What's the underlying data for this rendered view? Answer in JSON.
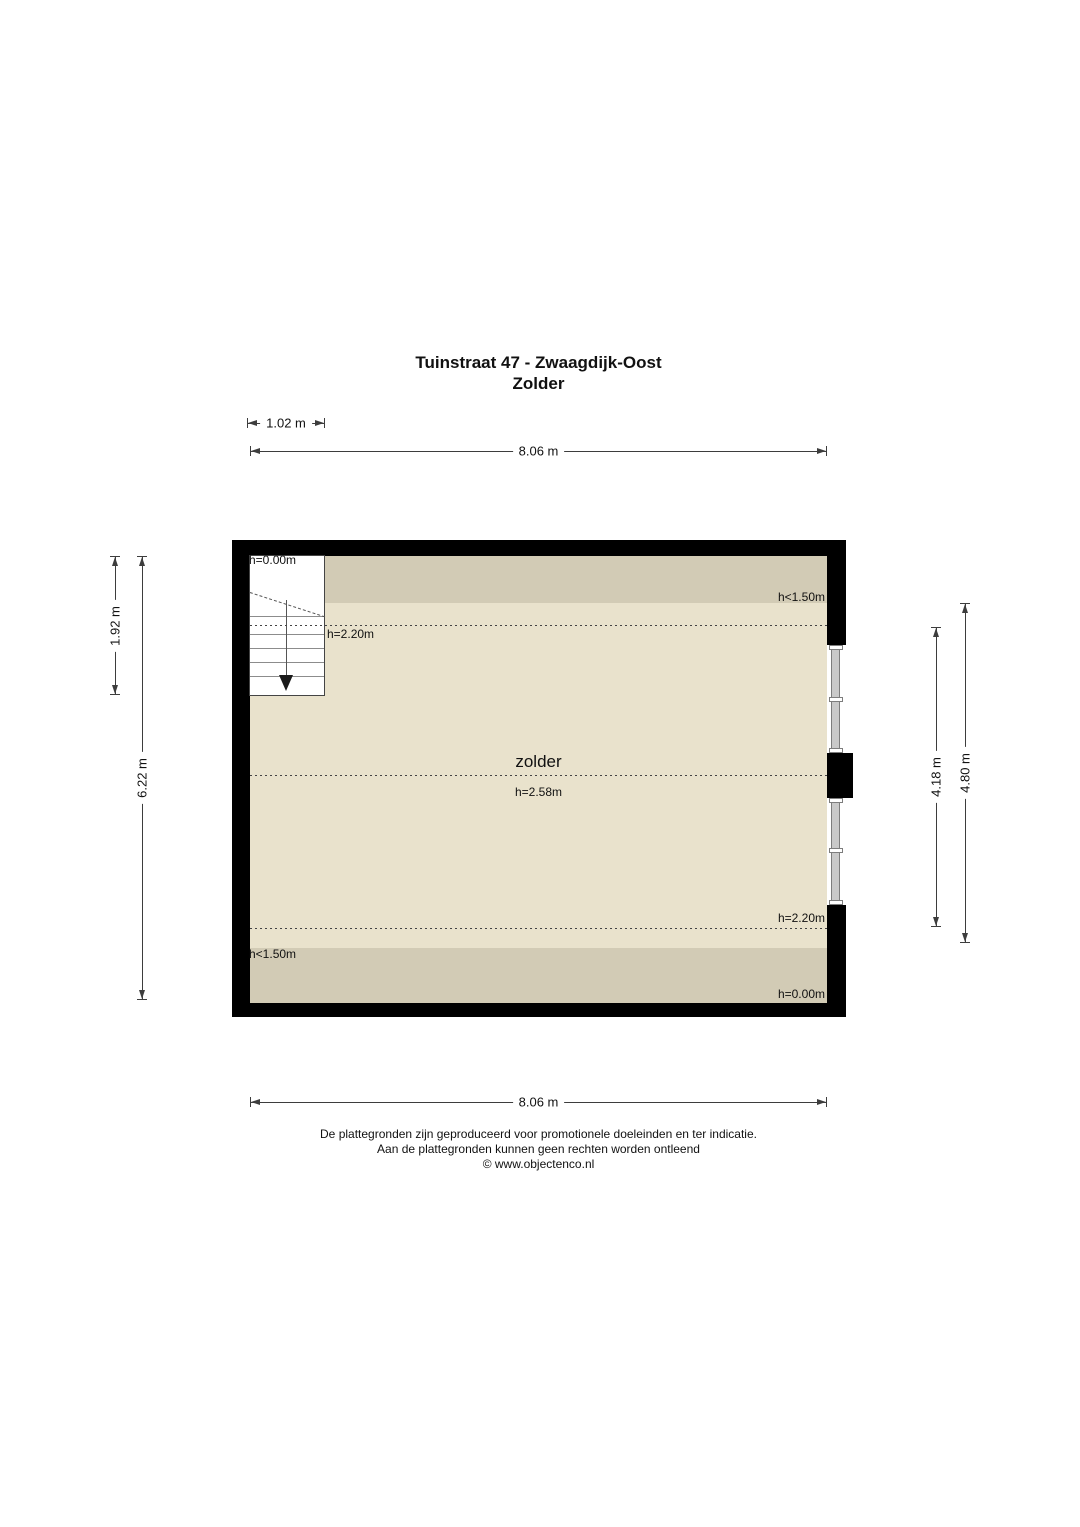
{
  "title": {
    "line1": "Tuinstraat 47 - Zwaagdijk-Oost",
    "line2": "Zolder"
  },
  "dimensions": {
    "top_small": "1.02 m",
    "top_width": "8.06 m",
    "left_upper": "1.92 m",
    "left_full": "6.22 m",
    "right_inner": "4.18 m",
    "right_outer": "4.80 m",
    "bottom_width": "8.06 m"
  },
  "floorplan": {
    "room_label": "zolder",
    "room_height": "h=2.58m",
    "annotations": {
      "stair_top": "h=0.00m",
      "top_right": "h<1.50m",
      "stair_height": "h=2.20m",
      "lower_right_height": "h=2.20m",
      "bottom_left": "h<1.50m",
      "bottom_right": "h=0.00m"
    },
    "colors": {
      "wall": "#000000",
      "floor": "#E9E2CC",
      "low_ceiling_zone": "#D2CBB5",
      "stairs": "#FFFFFF",
      "window_frame": "#C9C9C9"
    }
  },
  "footer": {
    "line1": "De plattegronden zijn geproduceerd voor promotionele doeleinden en ter indicatie.",
    "line2": "Aan de plattegronden kunnen geen rechten worden ontleend",
    "line3": "© www.objectenco.nl"
  }
}
